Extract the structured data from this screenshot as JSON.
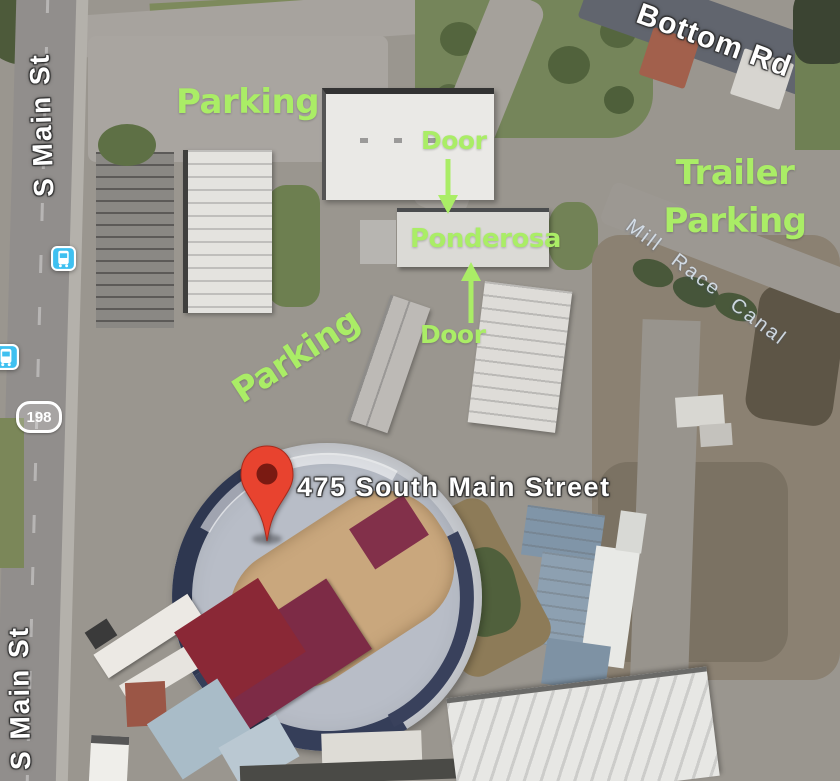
{
  "map": {
    "address_marker": {
      "label": "475 South Main Street",
      "pin_color": "#e8432f"
    },
    "roads": {
      "s_main_st": "S Main St",
      "bottom_rd": "Bottom Rd",
      "mill_race_canal": "Mill Race Canal",
      "route_badge": "198"
    },
    "annotations": {
      "color": "#aaed66",
      "parking_top": "Parking",
      "parking_diagonal": "Parking",
      "trailer_line1": "Trailer",
      "trailer_line2": "Parking",
      "door_upper": "Door",
      "door_lower": "Door",
      "ponderosa": "Ponderosa"
    },
    "icons": {
      "bus_stop": "bus-stop-icon",
      "transit_blue": "#3fc0f0",
      "pin": "location-pin-icon",
      "arrow_down": "arrow-down-icon",
      "arrow_up": "arrow-up-icon"
    },
    "colors": {
      "arena_dirt": "#c9a77d",
      "arena_stands": "#b8bdc7",
      "bleachers_maroon": "#7d2b46",
      "grass_green": "#75855a",
      "pavement_gray": "#9a968f",
      "road_dark": "#61656e"
    }
  }
}
